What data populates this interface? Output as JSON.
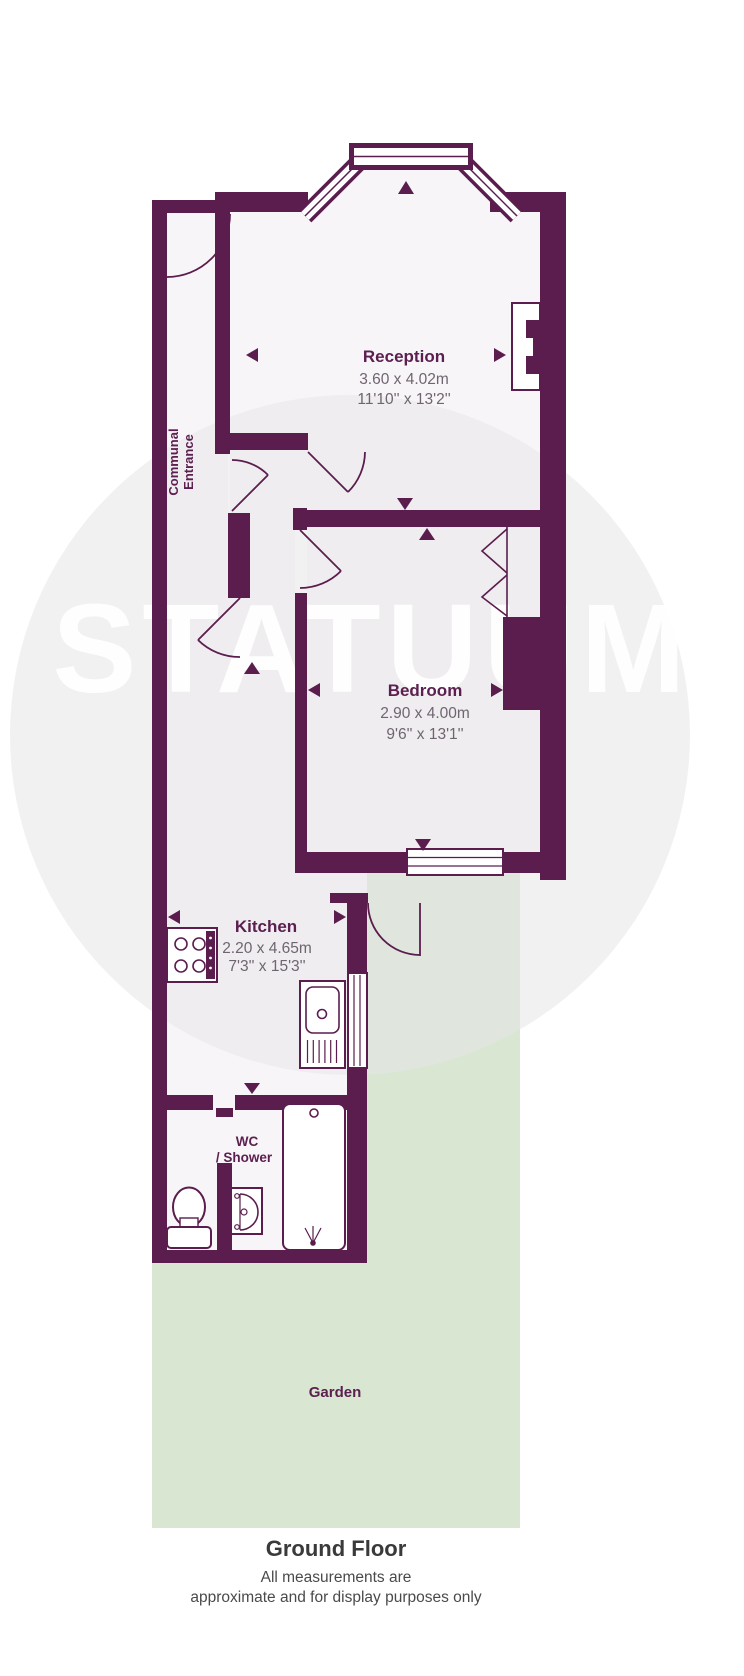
{
  "watermark": {
    "text": "STATUUM"
  },
  "rooms": {
    "reception": {
      "name": "Reception",
      "metric": "3.60 x 4.02m",
      "imperial": "11'10'' x 13'2''"
    },
    "bedroom": {
      "name": "Bedroom",
      "metric": "2.90 x 4.00m",
      "imperial": "9'6'' x 13'1''"
    },
    "kitchen": {
      "name": "Kitchen",
      "metric": "2.20 x 4.65m",
      "imperial": "7'3'' x 15'3''"
    },
    "wc": {
      "name": "WC",
      "name2": "/ Shower"
    },
    "garden": {
      "name": "Garden"
    },
    "communal_entrance": {
      "line1": "Communal",
      "line2": "Entrance"
    }
  },
  "footer": {
    "title": "Ground Floor",
    "disclaimer_line1": "All measurements are",
    "disclaimer_line2": "approximate and for display purposes only"
  },
  "colors": {
    "wall": "#5a1d4d",
    "garden": "#d8e6d2",
    "floor": "#f8f5f8",
    "room_label": "#5c2050",
    "dimension_text": "#6f6570",
    "watermark_circle": "#e8e6e8",
    "watermark_text": "#ffffff"
  }
}
